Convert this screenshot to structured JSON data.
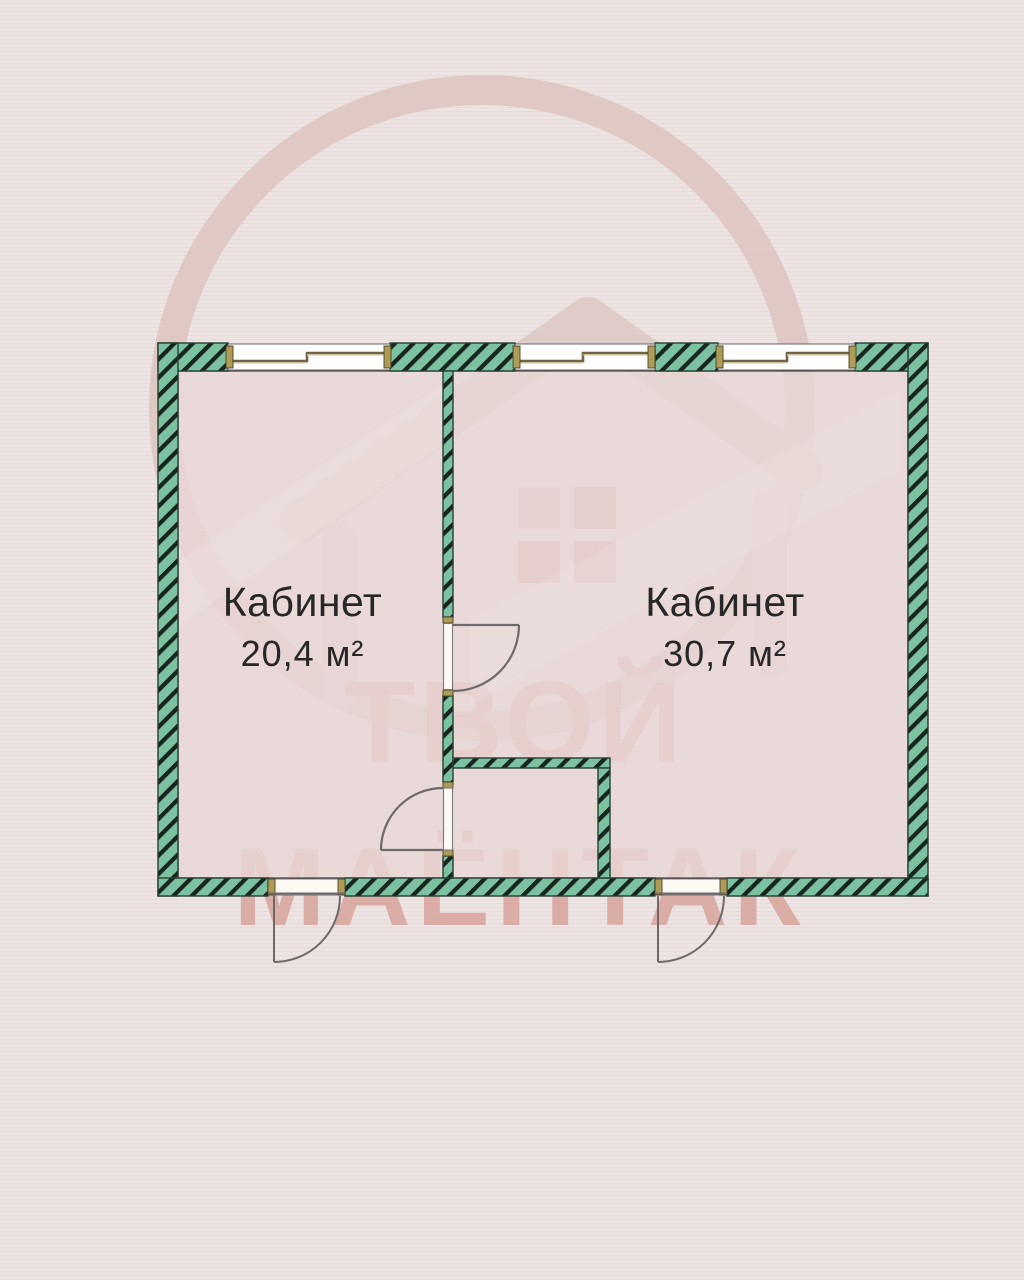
{
  "plan": {
    "title": "floor-plan",
    "rooms": [
      {
        "name": "Кабинет",
        "area": "20,4 м²"
      },
      {
        "name": "Кабинет",
        "area": "30,7 м²"
      }
    ],
    "features": {
      "windows_count": 3,
      "interior_doors_count": 2,
      "exterior_doors_count": 2
    }
  },
  "watermark": {
    "line1": "ТВОЙ",
    "line2": "МАЁНТАК"
  },
  "colors": {
    "background": "#ece3e2",
    "floor": "#e8d8d7",
    "wall_teal": "#7cc2a2",
    "wall_hatch": "#18241e",
    "jamb_tan": "#ad9c55",
    "door_line_gray": "#6f6a6a",
    "label_text": "#272727",
    "watermark_red": "#d6a098"
  }
}
